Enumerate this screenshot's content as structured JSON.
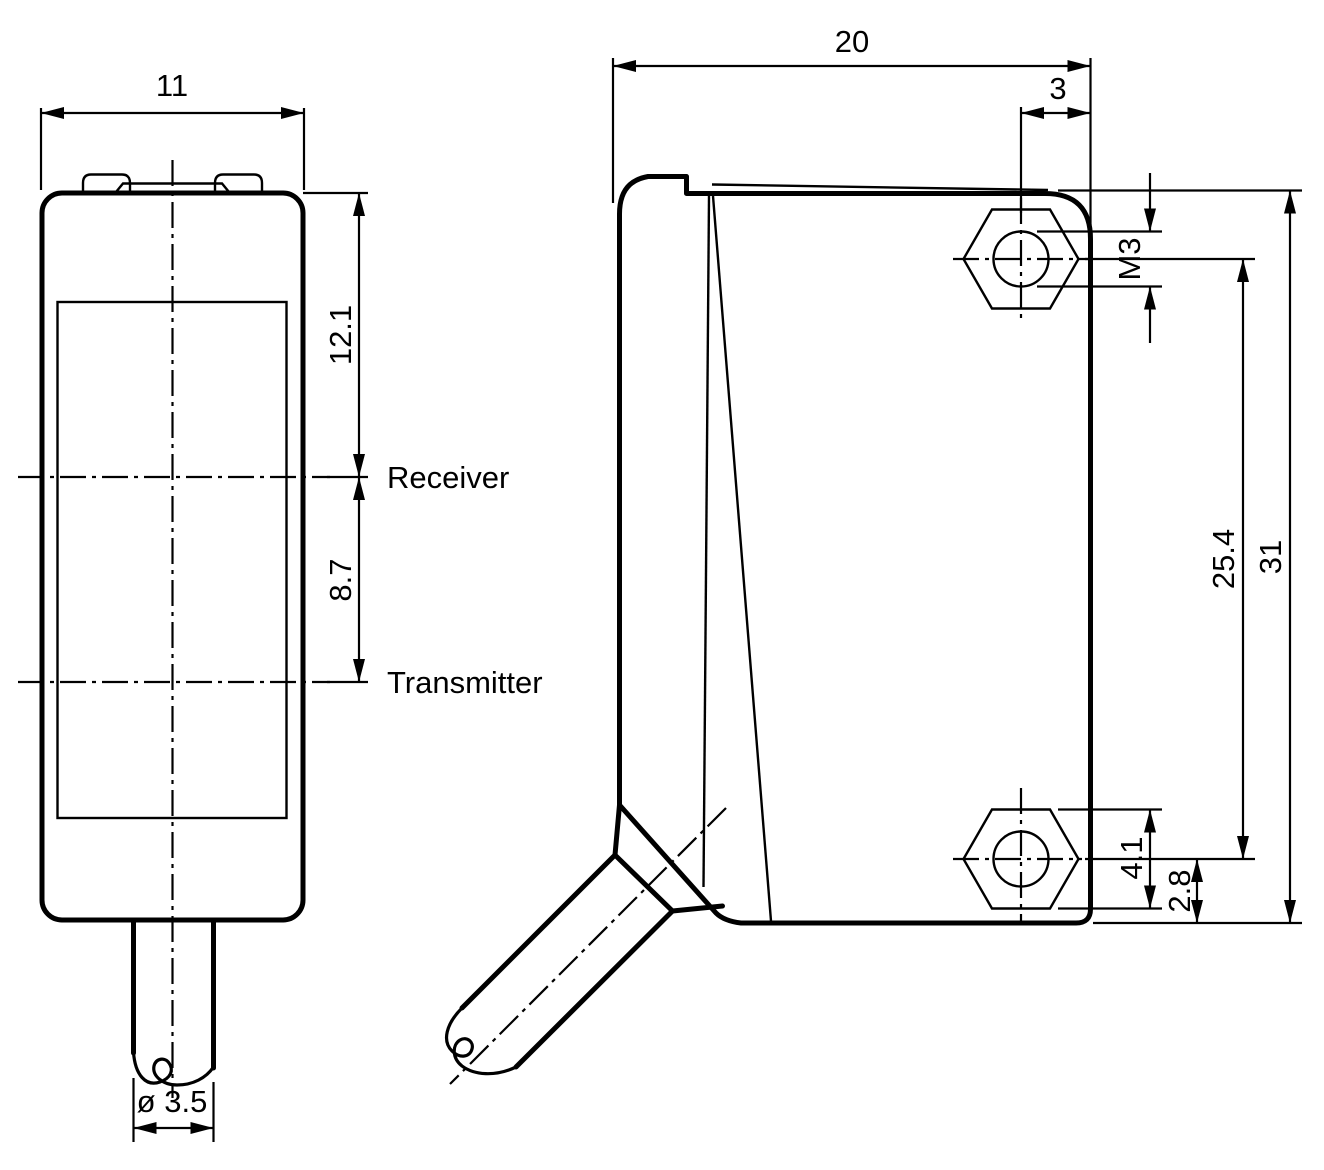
{
  "front_view": {
    "width_dim": "11",
    "receiver_from_top_dim": "12.1",
    "receiver_to_transmitter_dim": "8.7",
    "receiver_label": "Receiver",
    "transmitter_label": "Transmitter",
    "cable_diameter_dim": "ø 3.5"
  },
  "side_view": {
    "depth_dim": "20",
    "hole_to_edge_dim": "3",
    "thread_size_label": "M3",
    "hole_spacing_dim": "25.4",
    "height_dim": "31",
    "nut_across_flats_dim": "4.1",
    "hole_to_bottom_dim": "2.8"
  },
  "colors": {
    "line": "#000000",
    "background": "#ffffff"
  }
}
